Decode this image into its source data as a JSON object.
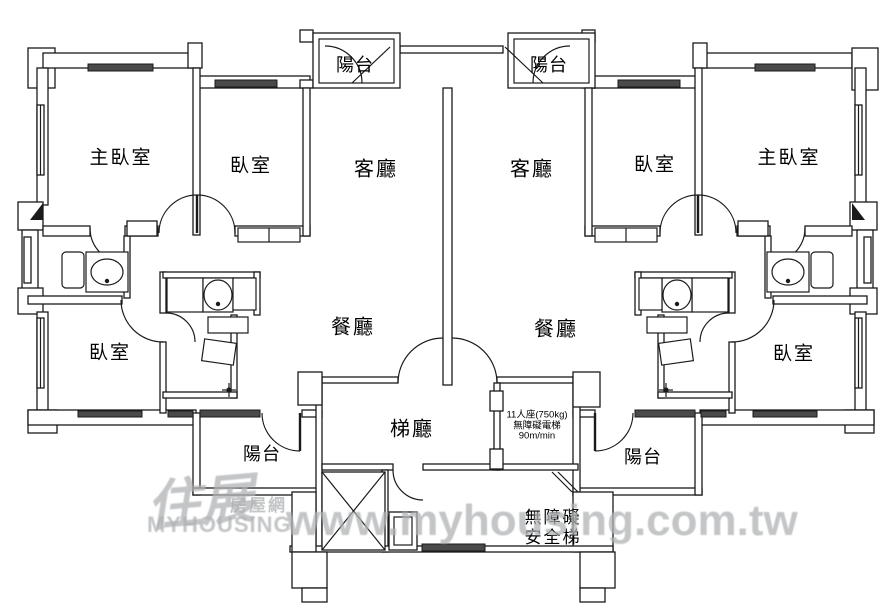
{
  "rooms": {
    "master_bedroom": "主臥室",
    "bedroom": "臥室",
    "living_room": "客廳",
    "dining_room": "餐廳",
    "balcony": "陽台",
    "elevator_hall": "梯廳"
  },
  "elevator_spec": {
    "line1": "11人座(750kg)",
    "line2": "無障礙電梯",
    "line3": "90m/min"
  },
  "accessible_stairs": {
    "line1": "無障礙",
    "line2": "安全梯"
  },
  "watermark": {
    "url": "www.myhousing.com.tw",
    "logo_chinese": "住展",
    "logo_sub": "房屋網",
    "logo_en": "MYHOUSING"
  },
  "colors": {
    "line": "#1a1a1a",
    "window_fill": "#4a4a4a",
    "watermark_gray": "#b0b3b5"
  }
}
